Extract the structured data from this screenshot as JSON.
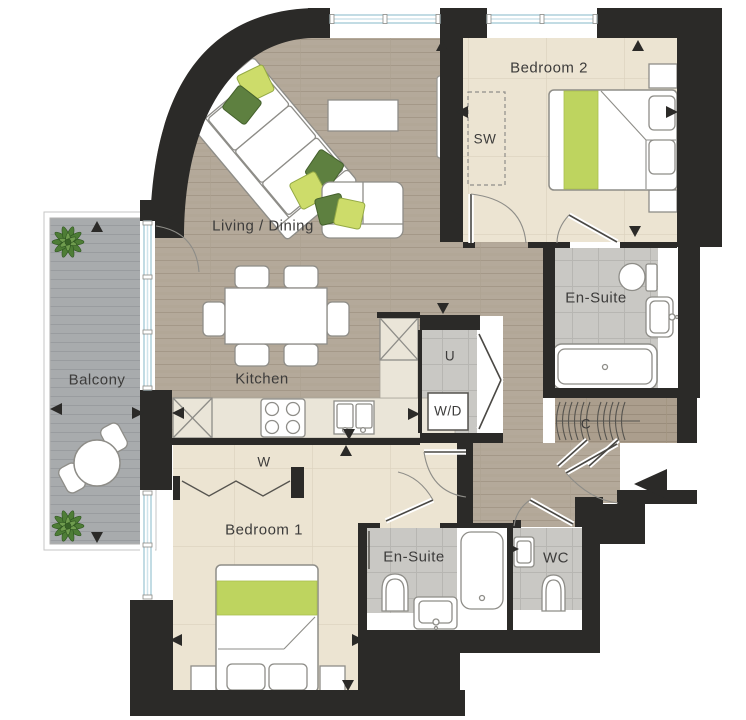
{
  "plan_title": "Apartment floor plan",
  "labels": {
    "living": "Living / Dining",
    "kitchen": "Kitchen",
    "balcony": "Balcony",
    "bedroom1": "Bedroom 1",
    "bedroom2": "Bedroom 2",
    "ensuite_top": "En-Suite",
    "ensuite_bottom": "En-Suite",
    "wc": "WC",
    "storage_wardrobe": "SW",
    "utility": "U",
    "washer_dryer": "W/D",
    "wardrobe": "W",
    "cupboard": "C"
  },
  "icons": {
    "entrance_arrow": "entrance-direction-left",
    "dimension_arrow": "dimension-marker-triangle",
    "plant": "potted-plant",
    "hangers": "coat-hangers"
  },
  "colors": {
    "wall": "#2b2a28",
    "wood_floor": "#b4a99a",
    "wood_line": "#a49888",
    "cupboard_wood": "#ab9e8d",
    "bedroom_floor": "#ece4d2",
    "bedroom_grid": "#ddd3bf",
    "tile": "#c9c8c4",
    "tile_grid": "#b7b6b2",
    "balcony_deck": "#a8abad",
    "deck_line": "#999c9f",
    "counter": "#eae5d8",
    "accent_lime": "#bed45f",
    "pillow_green": "#5e8040",
    "window_glazing": "#b7d7e3",
    "furniture_stroke": "#8e8d88",
    "label_text": "#3d3c3b"
  }
}
